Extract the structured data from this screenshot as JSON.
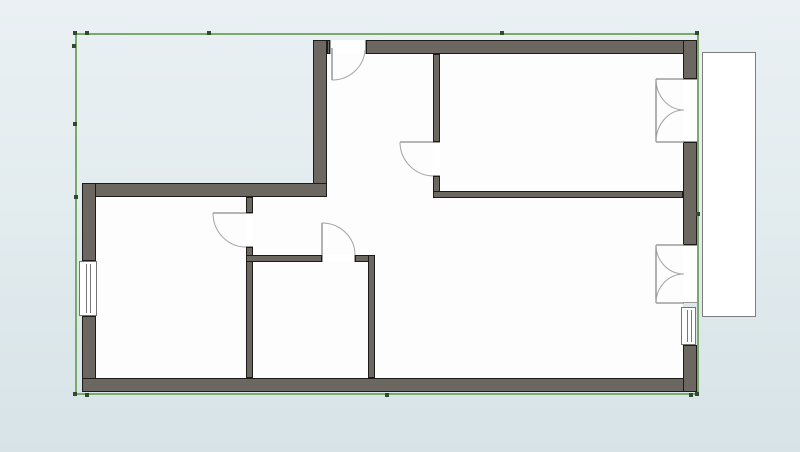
{
  "app": {
    "name": "floor-plan-editor",
    "view": "2d-plan-canvas"
  },
  "canvas": {
    "width": 800,
    "height": 452,
    "bg_top": "#eaf0f3",
    "bg_mid": "#e3ecef",
    "bg_bottom": "#d7e3e7"
  },
  "palette": {
    "wall_fill": "#6c6760",
    "wall_edge": "#1d1c19",
    "floor": "#fdfdfd",
    "opening_jamb": "#9a9a9a",
    "door_leaf": "#8a8a8a",
    "door_arc": "#a3a3a3",
    "window_frame": "#767676",
    "selection": "#79a96b",
    "handle": "#2f4b2b",
    "balcony_border": "#7e7e7e",
    "balcony_fill": "#ffffff"
  },
  "selection": {
    "x": 75,
    "y": 33,
    "w": 624,
    "h": 362,
    "border_px": 2,
    "handles": [
      [
        73,
        31
      ],
      [
        85,
        31
      ],
      [
        207,
        31
      ],
      [
        500,
        31
      ],
      [
        695,
        31
      ],
      [
        72,
        44
      ],
      [
        73,
        122
      ],
      [
        74,
        195
      ],
      [
        696,
        212
      ],
      [
        73,
        392
      ],
      [
        85,
        393
      ],
      [
        385,
        393
      ],
      [
        689,
        393
      ],
      [
        695,
        392
      ]
    ]
  },
  "floors": [
    {
      "name": "floor-lower-rooms",
      "x": 96,
      "y": 197,
      "w": 587,
      "h": 181
    },
    {
      "name": "floor-upper-rooms",
      "x": 327,
      "y": 54,
      "w": 356,
      "h": 143
    }
  ],
  "balcony": {
    "name": "balcony",
    "x": 702,
    "y": 52,
    "w": 54,
    "h": 265
  },
  "walls": [
    {
      "name": "wall-upper-left-vertical",
      "x": 313,
      "y": 40,
      "w": 14,
      "h": 157
    },
    {
      "name": "wall-top-stub",
      "x": 327,
      "y": 40,
      "w": 3,
      "h": 14
    },
    {
      "name": "wall-top",
      "x": 366,
      "y": 40,
      "w": 331,
      "h": 14
    },
    {
      "name": "wall-notch",
      "x": 82,
      "y": 183,
      "w": 245,
      "h": 14
    },
    {
      "name": "wall-left-upper",
      "x": 82,
      "y": 183,
      "w": 14,
      "h": 78
    },
    {
      "name": "wall-left-lower",
      "x": 82,
      "y": 316,
      "w": 14,
      "h": 76
    },
    {
      "name": "wall-bottom",
      "x": 82,
      "y": 378,
      "w": 615,
      "h": 14
    },
    {
      "name": "wall-right-upper",
      "x": 683,
      "y": 40,
      "w": 14,
      "h": 39
    },
    {
      "name": "wall-right-middle",
      "x": 683,
      "y": 142,
      "w": 14,
      "h": 103
    },
    {
      "name": "wall-right-lower",
      "x": 683,
      "y": 345,
      "w": 14,
      "h": 47
    },
    {
      "name": "wall-hall-bedroom-upper",
      "x": 433,
      "y": 54,
      "w": 7,
      "h": 88
    },
    {
      "name": "wall-hall-bedroom-lower",
      "x": 433,
      "y": 176,
      "w": 7,
      "h": 22
    },
    {
      "name": "wall-bedroom-living",
      "x": 433,
      "y": 191,
      "w": 250,
      "h": 7
    },
    {
      "name": "wall-left-bedroom-upper",
      "x": 246,
      "y": 197,
      "w": 7,
      "h": 16
    },
    {
      "name": "wall-left-bedroom-lower",
      "x": 246,
      "y": 247,
      "w": 7,
      "h": 131
    },
    {
      "name": "wall-small-room-top-left",
      "x": 246,
      "y": 255,
      "w": 76,
      "h": 7
    },
    {
      "name": "wall-small-room-top-right",
      "x": 355,
      "y": 255,
      "w": 20,
      "h": 7
    },
    {
      "name": "wall-small-room-right",
      "x": 368,
      "y": 255,
      "w": 7,
      "h": 123
    }
  ],
  "openings": [
    {
      "name": "entry-door-opening",
      "x": 330,
      "y": 40,
      "w": 36,
      "h": 14,
      "jamb": "v"
    },
    {
      "name": "hall-bedroom-door-opening",
      "x": 433,
      "y": 142,
      "w": 7,
      "h": 34,
      "jamb": "h"
    },
    {
      "name": "left-bedroom-door-opening",
      "x": 246,
      "y": 213,
      "w": 7,
      "h": 34,
      "jamb": "h"
    },
    {
      "name": "small-room-door-opening",
      "x": 322,
      "y": 255,
      "w": 33,
      "h": 7,
      "jamb": "v"
    },
    {
      "name": "balcony-door-upper-opening",
      "x": 683,
      "y": 79,
      "w": 14,
      "h": 63,
      "jamb": "h"
    },
    {
      "name": "balcony-door-lower-opening",
      "x": 683,
      "y": 245,
      "w": 14,
      "h": 58,
      "jamb": "h"
    }
  ],
  "windows": [
    {
      "name": "left-wall-window",
      "x": 79,
      "y": 261,
      "w": 18,
      "h": 55,
      "l1": 6,
      "l2": 10
    },
    {
      "name": "right-wall-window",
      "x": 681,
      "y": 307,
      "w": 15,
      "h": 38,
      "l1": 5,
      "l2": 9
    }
  ],
  "doors": [
    {
      "name": "entry-door",
      "lines": [
        [
          332,
          48,
          332,
          80
        ]
      ],
      "arcs": [
        "M 332 80 A 33 32 0 0 0 365 50"
      ]
    },
    {
      "name": "hall-bedroom-door",
      "lines": [
        [
          400,
          142,
          433,
          142
        ]
      ],
      "arcs": [
        "M 400 142 A 34 34 0 0 0 433 176"
      ]
    },
    {
      "name": "left-bedroom-door",
      "lines": [
        [
          213,
          213,
          246,
          213
        ]
      ],
      "arcs": [
        "M 213 213 A 33 34 0 0 0 246 247"
      ]
    },
    {
      "name": "small-room-door",
      "lines": [
        [
          322,
          223,
          322,
          255
        ]
      ],
      "arcs": [
        "M 322 223 A 33 32 0 0 1 355 255"
      ]
    },
    {
      "name": "balcony-double-door-upper",
      "lines": [
        [
          656,
          79,
          684,
          79
        ],
        [
          656,
          142,
          684,
          142
        ],
        [
          656,
          79,
          656,
          142
        ]
      ],
      "arcs": [
        "M 656 79 A 28 31 0 0 0 684 110",
        "M 656 142 A 28 32 0 0 1 684 110"
      ]
    },
    {
      "name": "balcony-double-door-lower",
      "lines": [
        [
          656,
          245,
          684,
          245
        ],
        [
          656,
          303,
          684,
          303
        ],
        [
          656,
          245,
          656,
          303
        ]
      ],
      "arcs": [
        "M 656 245 A 28 29 0 0 0 684 274",
        "M 656 303 A 28 29 0 0 1 684 274"
      ]
    }
  ]
}
